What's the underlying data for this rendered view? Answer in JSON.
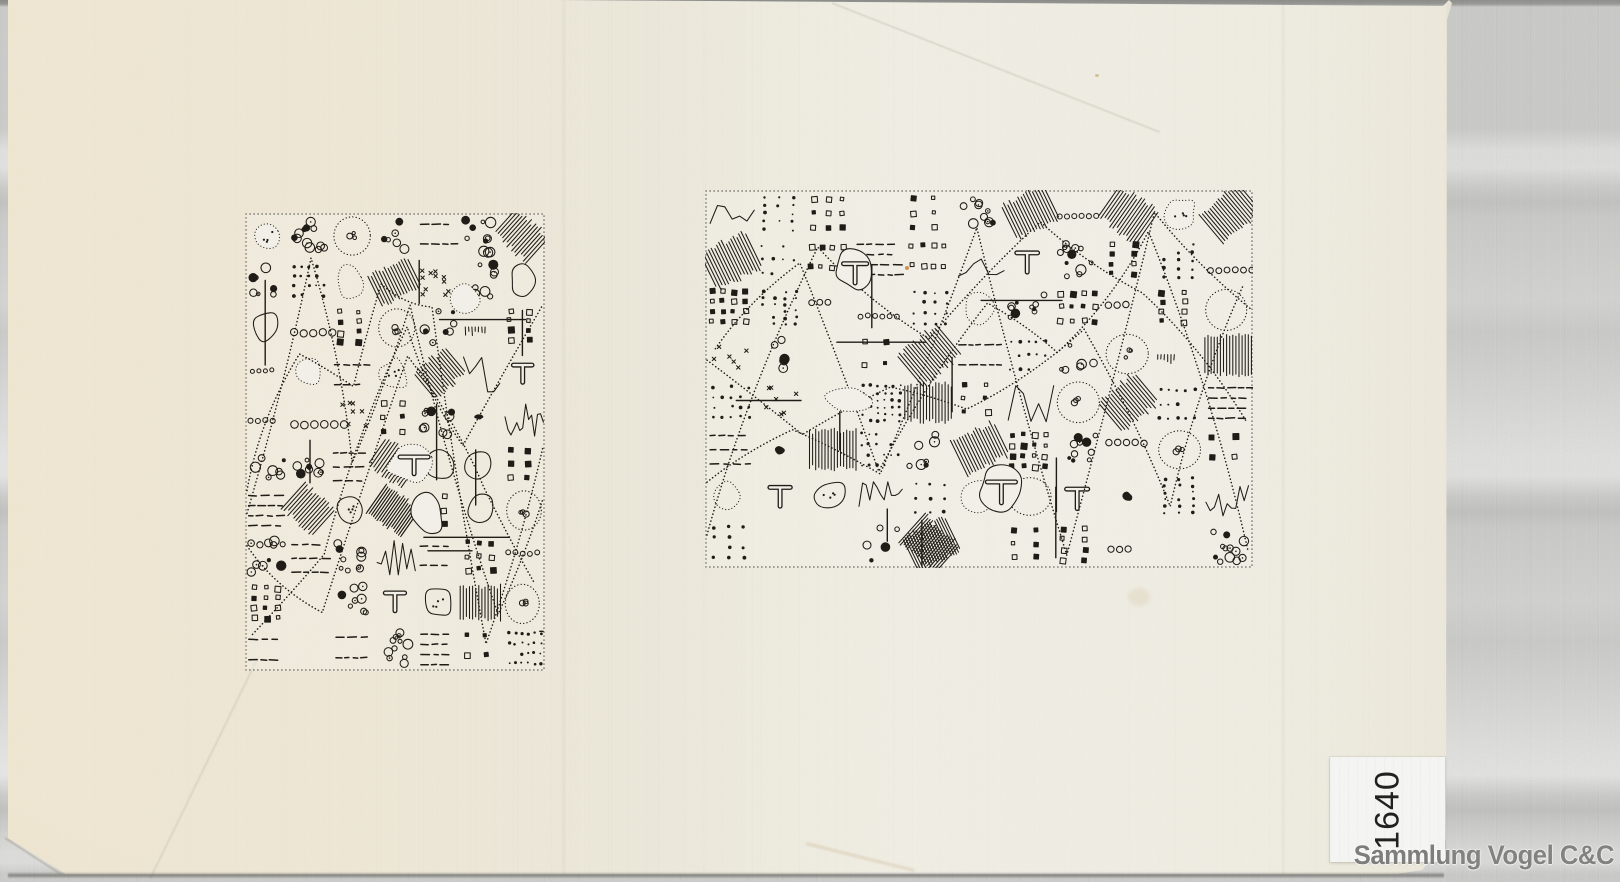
{
  "scan": {
    "watermark": "Sammlung Vogel C&C",
    "label": {
      "number": "1640"
    },
    "colors": {
      "ink": "#1b1712",
      "paper": "#ece8da",
      "paper_bright": "#f3f1e9",
      "scanner_band": "#cbccc9",
      "label_bg": "#f6f6f4",
      "watermark_gray": "#7c7c7c"
    },
    "drawings": [
      {
        "id": "left",
        "x": 245,
        "y": 213,
        "width": 300,
        "height": 458,
        "seed": 20231,
        "cell": 46,
        "skip": 0.05,
        "description": "dense abstract pen-and-ink doodle, portrait block"
      },
      {
        "id": "right",
        "x": 705,
        "y": 190,
        "width": 548,
        "height": 378,
        "seed": 47711,
        "cell": 50,
        "skip": 0.1,
        "description": "dense abstract pen-and-ink doodle, landscape block"
      }
    ]
  }
}
